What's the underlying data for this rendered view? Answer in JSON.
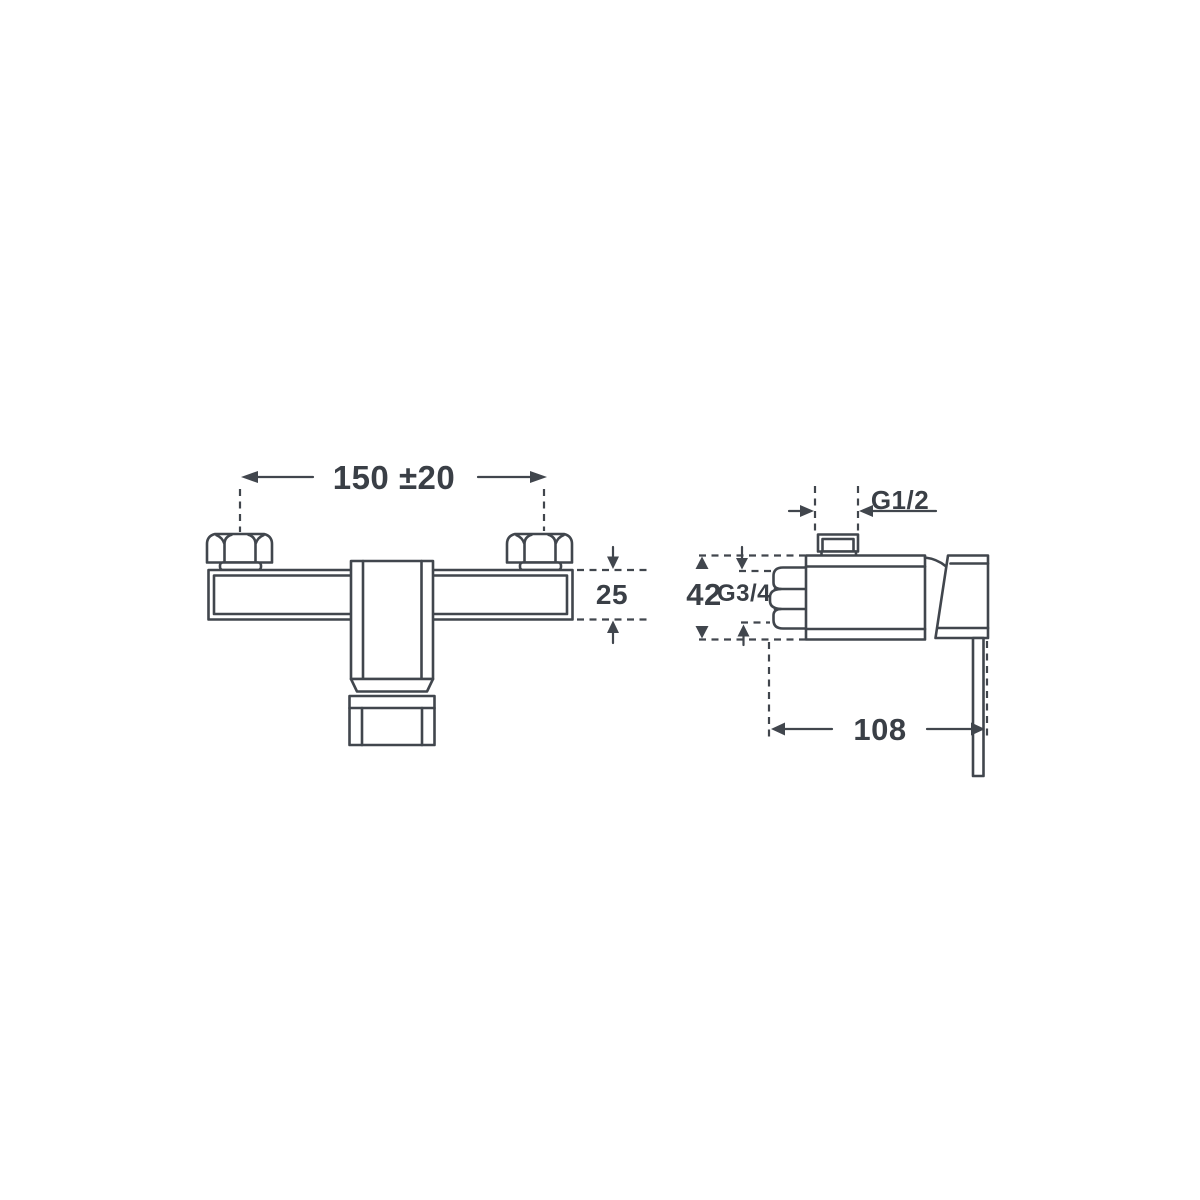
{
  "colors": {
    "background": "#ffffff",
    "line": "#41464d",
    "text": "#3a3f46"
  },
  "front_view": {
    "width_dim": "150 ±20",
    "height_dim": "25"
  },
  "side_view": {
    "top_thread_dim": "G1/2",
    "height_dim": "42",
    "inlet_thread_dim": "G3/4",
    "depth_dim": "108"
  }
}
